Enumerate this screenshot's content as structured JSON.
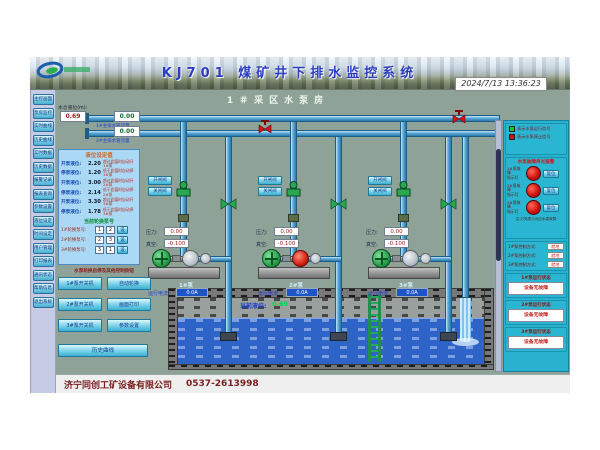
{
  "header": {
    "title": "KJ701 煤矿井下排水监控系统",
    "datetime": "2024/7/13 13:36:23"
  },
  "sidebar": {
    "items": [
      {
        "label": "主控画面"
      },
      {
        "label": "泵房监控"
      },
      {
        "label": "实时曲线"
      },
      {
        "label": "历史曲线"
      },
      {
        "label": "实时数据"
      },
      {
        "label": "历史数据"
      },
      {
        "label": "报警记录"
      },
      {
        "label": "报表查询"
      },
      {
        "label": "参数设置"
      },
      {
        "label": "液位设定"
      },
      {
        "label": "时间设定"
      },
      {
        "label": "用户管理"
      },
      {
        "label": "打印报表"
      },
      {
        "label": "通讯状态"
      },
      {
        "label": "帮助信息"
      },
      {
        "label": "退出系统"
      }
    ]
  },
  "main": {
    "room_title": "1＃采区水泵房",
    "sump_level_label": "水仓液位(m):",
    "sump_level_value": "0.69",
    "flow1": {
      "value": "0.00",
      "label": "1#主排水管流量"
    },
    "flow2": {
      "value": "0.00",
      "label": "2#主排水管流量"
    },
    "current_level_label": "当前液位:",
    "current_level_value": "0.69"
  },
  "level_panel": {
    "title": "液位设定值",
    "rows": [
      {
        "label": "开泵液位:",
        "value": "2.20",
        "note": "超过此值时自动开1#泵"
      },
      {
        "label": "停泵液位:",
        "value": "1.20",
        "note": "低于此值时自动停1#泵"
      },
      {
        "label": "开泵液位:",
        "value": "3.00",
        "note": "超过此值时自动开2#泵"
      },
      {
        "label": "停泵液位:",
        "value": "2.14",
        "note": "低于此值时自动停2#泵"
      },
      {
        "label": "开泵液位:",
        "value": "3.30",
        "note": "超过此值时自动开3#泵"
      },
      {
        "label": "停泵液位:",
        "value": "1.78",
        "note": "低于此值时自动停3#泵"
      }
    ],
    "rotation_title": "当前轮换泵号",
    "rotation_rows": [
      {
        "label": "1#轮换泵号:",
        "box1": "1",
        "box2": "2",
        "btn": "设"
      },
      {
        "label": "2#轮换泵号:",
        "box1": "2",
        "box2": "3",
        "btn": "设"
      },
      {
        "label": "3#轮换泵号:",
        "box1": "3",
        "box2": "1",
        "btn": "设"
      }
    ]
  },
  "control_panel": {
    "title": "水泵轮换启停及其他控制按钮",
    "buttons": [
      {
        "label": "1#泵开关机"
      },
      {
        "label": "自动轮换"
      },
      {
        "label": "2#泵开关机"
      },
      {
        "label": "画面打印"
      },
      {
        "label": "3#泵开关机"
      },
      {
        "label": "参数设置"
      }
    ],
    "wide_button": "历史曲线"
  },
  "pumps": {
    "valve_open_btn": "开闸阀",
    "valve_close_btn": "关闸阀",
    "units": [
      {
        "name": "1#泵",
        "pressure_label": "压力:",
        "pressure": "0.00",
        "vacuum_label": "真空:",
        "vacuum": "-0.100",
        "current_label": "运行电流",
        "current": "0.0A"
      },
      {
        "name": "2#泵",
        "pressure_label": "压力:",
        "pressure": "0.00",
        "vacuum_label": "真空:",
        "vacuum": "-0.100",
        "current_label": "运行电流",
        "current": "0.0A"
      },
      {
        "name": "3#泵",
        "pressure_label": "压力:",
        "pressure": "0.00",
        "vacuum_label": "真空:",
        "vacuum": "-0.100",
        "current_label": "运行电流",
        "current": "0.0A"
      }
    ]
  },
  "right_panel": {
    "legend": [
      {
        "text": "表示水泵运行信号"
      },
      {
        "text": "表示水泵停止信号"
      }
    ],
    "alarm": {
      "title": "水泵故障声光报警",
      "rows": [
        {
          "label": "1#泵故障",
          "sub": "指示灯",
          "btn": "复位"
        },
        {
          "label": "2#泵故障",
          "sub": "指示灯",
          "btn": "复位"
        },
        {
          "label": "3#泵故障",
          "sub": "指示灯",
          "btn": "复位"
        }
      ],
      "note": "注:灯亮表示对应水泵故障"
    },
    "modes": [
      {
        "label": "1#泵控制方式:",
        "value": "就地"
      },
      {
        "label": "2#泵控制方式:",
        "value": "就地"
      },
      {
        "label": "3#泵控制方式:",
        "value": "就地"
      }
    ],
    "status": [
      {
        "header": "1#泵运行状态",
        "value": "设备无故障"
      },
      {
        "header": "2#泵运行状态",
        "value": "设备无故障"
      },
      {
        "header": "3#泵运行状态",
        "value": "设备无故障"
      }
    ]
  },
  "footer": {
    "company": "济宁同创工矿设备有限公司",
    "phone": "0537-2613998"
  },
  "colors": {
    "accent_teal": "#28b2cf",
    "run_green": "#16c02e",
    "stop_red": "#c81616",
    "pipe_blue": "#5aa8d8",
    "panel_blue": "#a9d9f5",
    "bg_sage": "#8ea297"
  }
}
